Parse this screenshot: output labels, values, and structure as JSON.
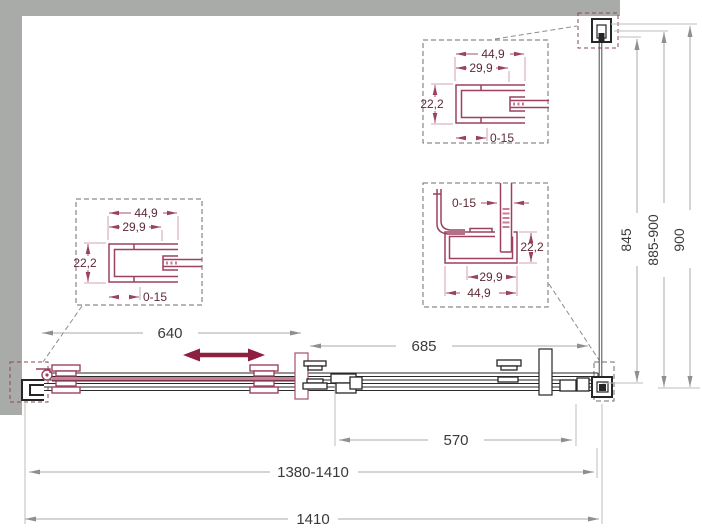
{
  "colors": {
    "wall_gray": "#a9aba8",
    "line_black": "#262626",
    "dim_gray": "#a8a8a8",
    "dim_text": "#3a3a3a",
    "profile_red": "#9c4160",
    "arrow_red": "#8e1f3f"
  },
  "details": {
    "left": {
      "width_outer": "44,9",
      "width_inner": "29,9",
      "height": "22,2",
      "adjust": "0-15"
    },
    "top": {
      "width_outer": "44,9",
      "width_inner": "29,9",
      "height": "22,2",
      "adjust": "0-15"
    },
    "corner": {
      "adjust": "0-15",
      "height": "22,2",
      "width_inner": "29,9",
      "width_outer": "44,9"
    }
  },
  "dimensions": {
    "door_travel": "640",
    "fixed_section": "685",
    "side_section": "570",
    "width_range": "1380-1410",
    "width_total": "1410",
    "depth_glass": "845",
    "depth_range": "885-900",
    "depth_total": "900"
  }
}
